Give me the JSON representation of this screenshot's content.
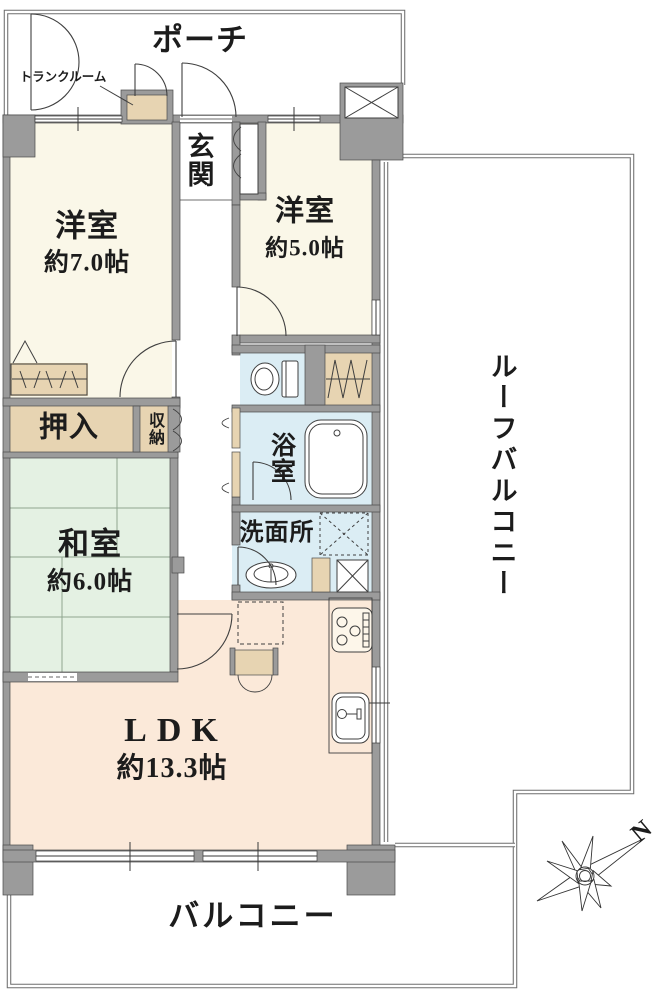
{
  "floor_plan": {
    "rooms": {
      "porch": {
        "label": "ポーチ"
      },
      "trunk_room": {
        "label": "トランクルーム"
      },
      "entrance": {
        "label": "玄関"
      },
      "western_room_7": {
        "label": "洋室",
        "size": "約7.0帖"
      },
      "western_room_5": {
        "label": "洋室",
        "size": "約5.0帖"
      },
      "closet_oshiire": {
        "label": "押入"
      },
      "closet_shunou": {
        "label": "収納"
      },
      "japanese_room": {
        "label": "和室",
        "size": "約6.0帖"
      },
      "bathroom": {
        "label": "浴室"
      },
      "washroom": {
        "label": "洗面所"
      },
      "ldk": {
        "label": "LDK",
        "size": "約13.3帖"
      },
      "balcony": {
        "label": "バルコニー"
      },
      "roof_balcony": {
        "label": "ルーフバルコニー"
      }
    },
    "compass": {
      "north_label": "N"
    },
    "colors": {
      "wall": "#9b9b9b",
      "western_room": "#faf7e8",
      "japanese_room": "#e4f1e3",
      "ldk": "#fbe9d9",
      "wet_area": "#dbedf4",
      "closet": "#e7d4b2"
    }
  }
}
